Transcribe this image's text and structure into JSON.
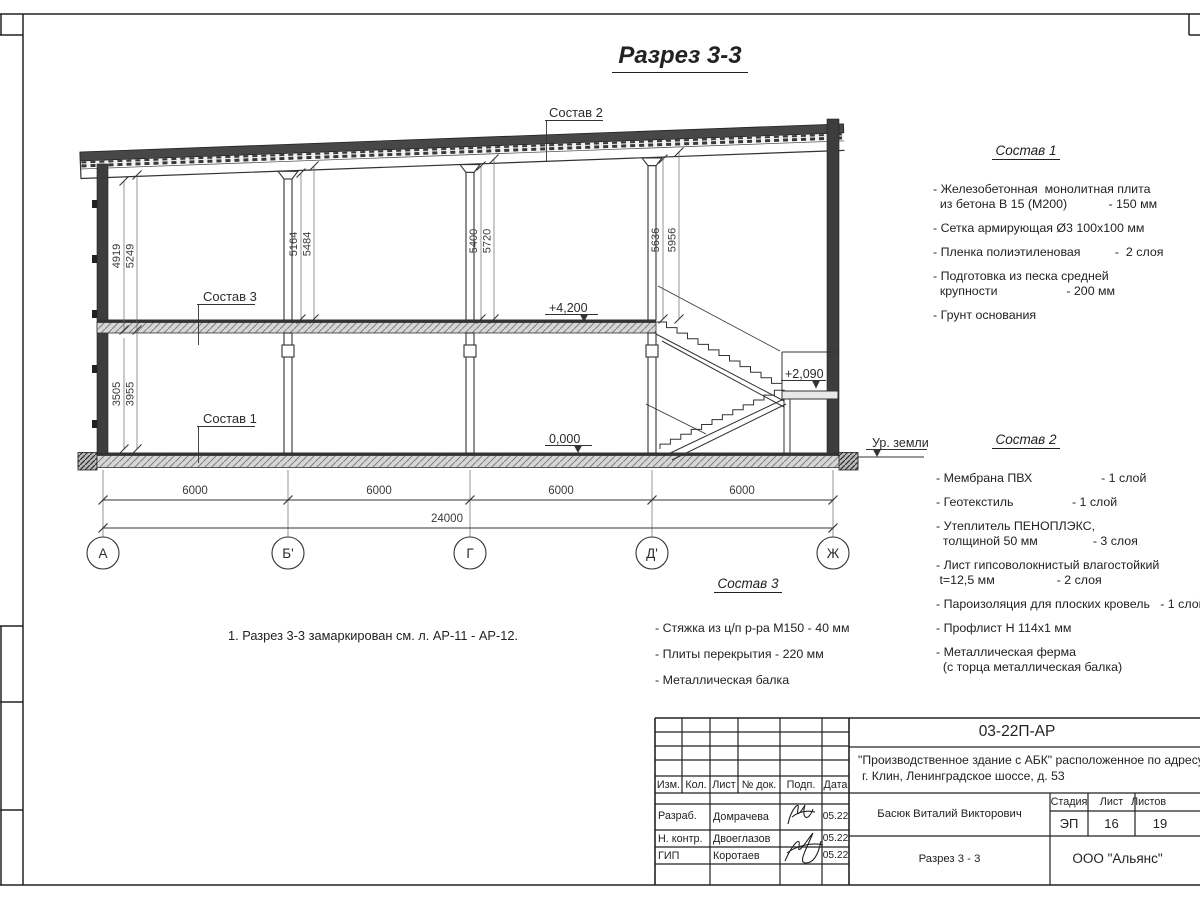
{
  "sheet": {
    "title": "Разрез 3-3",
    "note": "1. Разрез 3-3 замаркирован см. л. АР-11 - АР-12."
  },
  "drawing": {
    "axes": [
      "А",
      "Б'",
      "Г",
      "Д'",
      "Ж"
    ],
    "dims": {
      "wall_up": [
        "4919",
        "5249"
      ],
      "wall_low": [
        "3505",
        "3955"
      ],
      "b": [
        "5164",
        "5484"
      ],
      "g": [
        "5400",
        "5720"
      ],
      "d": [
        "5636",
        "5956"
      ],
      "spans": [
        "6000",
        "6000",
        "6000",
        "6000"
      ],
      "total": "24000"
    },
    "elev": {
      "floor2": "+4,200",
      "zero": "0,000",
      "landing": "+2,090",
      "ground": "Ур. земли"
    },
    "callouts": {
      "c1": "Состав 1",
      "c2": "Состав 2",
      "c3": "Состав 3"
    }
  },
  "compositions": [
    {
      "title": "Состав 1",
      "items": [
        [
          "- Железобетонная  монолитная плита",
          "  из бетона В 15 (М200)            - 150 мм"
        ],
        [
          "- Сетка армирующая Ø3 100х100 мм"
        ],
        [
          "- Пленка полиэтиленовая          -  2 слоя"
        ],
        [
          "- Подготовка из песка средней",
          "  крупности                    - 200 мм"
        ],
        [
          "- Грунт основания"
        ]
      ]
    },
    {
      "title": "Состав 2",
      "items": [
        [
          "- Мембрана ПВХ                    - 1 слой"
        ],
        [
          "- Геотекстиль                 - 1 слой"
        ],
        [
          "- Утеплитель ПЕНОПЛЭКС,",
          "  толщиной 50 мм                - 3 слоя"
        ],
        [
          "- Лист гипсоволокнистый влагостойкий",
          " t=12,5 мм                  - 2 слоя"
        ],
        [
          "- Пароизоляция для плоских кровель   - 1 слой"
        ],
        [
          "- Профлист Н 114х1 мм"
        ],
        [
          "- Металлическая ферма",
          "  (с торца металлическая балка)"
        ]
      ]
    },
    {
      "title": "Состав 3",
      "items": [
        [
          "- Стяжка из ц/п р-ра М150 - 40 мм"
        ],
        [
          "- Плиты перекрытия - 220 мм"
        ],
        [
          "- Металлическая балка"
        ]
      ]
    }
  ],
  "titleblock": {
    "doc": "03-22П-АР",
    "object1": "\"Производственное здание с АБК\" расположенное по адресу:",
    "object2": "г. Клин, Ленинградское шоссе, д. 53",
    "cols": [
      "Изм.",
      "Кол.",
      "Лист",
      "№ док.",
      "Подп.",
      "Дата"
    ],
    "people": [
      {
        "role": "Разраб.",
        "name": "Домрачева",
        "date": "05.22"
      },
      {
        "role": "Н. контр.",
        "name": "Двоеглазов",
        "date": "05.22"
      },
      {
        "role": "ГИП",
        "name": "Коротаев",
        "date": "05.22"
      }
    ],
    "supervisor": "Басюк Виталий Викторович",
    "drawing_title": "Разрез 3 - 3",
    "stage_h": "Стадия",
    "sheet_h": "Лист",
    "sheets_h": "Листов",
    "stage": "ЭП",
    "sheet": "16",
    "sheets": "19",
    "company": "ООО \"Альянс\""
  }
}
